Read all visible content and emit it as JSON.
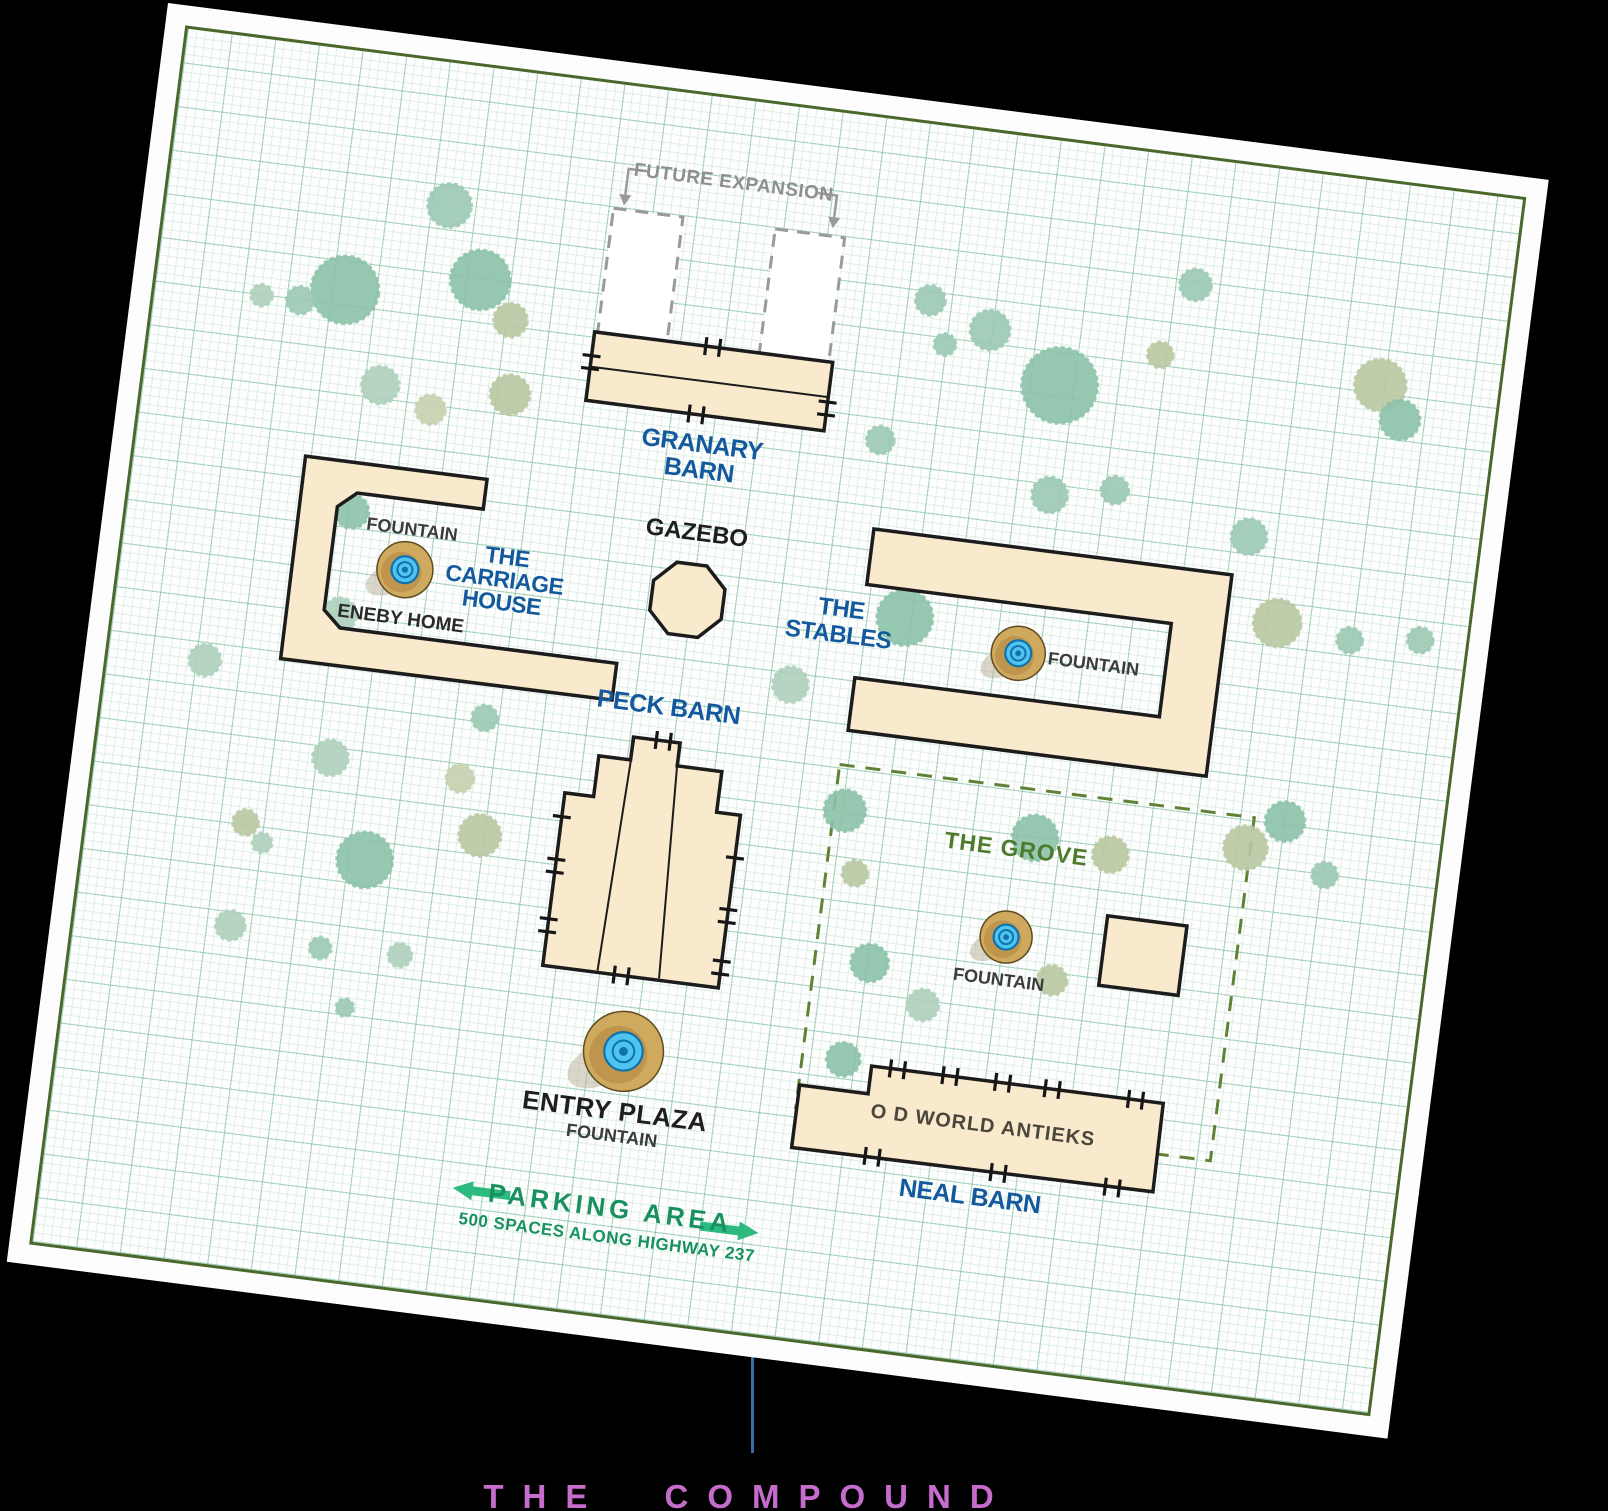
{
  "title": "THE COMPOUND",
  "map": {
    "future_expansion": {
      "label": "FUTURE EXPANSION"
    },
    "granary_barn": {
      "label_line1": "GRANARY",
      "label_line2": "BARN"
    },
    "gazebo": {
      "label": "GAZEBO"
    },
    "carriage_house": {
      "label_line1": "THE",
      "label_line2": "CARRIAGE",
      "label_line3": "HOUSE",
      "fountain_label": "FOUNTAIN",
      "home_label": "ENEBY HOME"
    },
    "stables": {
      "label_line1": "THE",
      "label_line2": "STABLES",
      "fountain_label": "FOUNTAIN"
    },
    "peck_barn": {
      "label": "PECK BARN"
    },
    "grove": {
      "label": "THE GROVE",
      "fountain_label": "FOUNTAIN"
    },
    "entry_plaza": {
      "label_line1": "ENTRY PLAZA",
      "label_line2": "FOUNTAIN"
    },
    "parking": {
      "label": "PARKING AREA",
      "sublabel": "500 SPACES ALONG HIGHWAY 237"
    },
    "neal_barn": {
      "building_text": "O D WORLD ANTIEKS",
      "label": "NEAL BARN"
    }
  },
  "colors": {
    "background": "#000000",
    "paper": "#fcfdfc",
    "border_green": "#4a682c",
    "grid_green": "#bfddd0",
    "building_fill": "#f9e9cd",
    "building_stroke": "#1c1c1c",
    "label_blue": "#14599d",
    "label_green": "#4d7a2b",
    "parking_green": "#18915f",
    "arrow_green": "#2cba7e",
    "title_magenta": "#c56ccd",
    "pointer_blue": "#3a6da7",
    "fountain_tan": "#cfa95d",
    "fountain_blue": "#4fc4f1",
    "fountain_blue_dark": "#0f72ad",
    "tree_palette": [
      "#9bc9b3",
      "#8cc2a9",
      "#aecfbb",
      "#b9c8a2",
      "#c7cfae"
    ]
  },
  "trees": [
    [
      305,
      165,
      22,
      0
    ],
    [
      212,
      262,
      34,
      1
    ],
    [
      169,
      278,
      14,
      0
    ],
    [
      130,
      278,
      11,
      2
    ],
    [
      345,
      235,
      30,
      1
    ],
    [
      380,
      271,
      17,
      3
    ],
    [
      259,
      352,
      19,
      2
    ],
    [
      312,
      370,
      15,
      4
    ],
    [
      389,
      345,
      20,
      3
    ],
    [
      794,
      198,
      15,
      0
    ],
    [
      814,
      240,
      11,
      0
    ],
    [
      857,
      220,
      20,
      0
    ],
    [
      933,
      266,
      38,
      1
    ],
    [
      1029,
      223,
      13,
      3
    ],
    [
      1055,
      149,
      16,
      0
    ],
    [
      1251,
      225,
      26,
      3
    ],
    [
      1275,
      257,
      20,
      1
    ],
    [
      762,
      343,
      14,
      0
    ],
    [
      937,
      376,
      18,
      0
    ],
    [
      1001,
      363,
      14,
      0
    ],
    [
      1140,
      392,
      18,
      0
    ],
    [
      1179,
      474,
      24,
      3
    ],
    [
      1253,
      482,
      13,
      0
    ],
    [
      1323,
      473,
      13,
      0
    ],
    [
      809,
      516,
      28,
      1
    ],
    [
      704,
      597,
      18,
      2
    ],
    [
      120,
      647,
      16,
      2
    ],
    [
      405,
      669,
      13,
      0
    ],
    [
      257,
      728,
      18,
      2
    ],
    [
      388,
      732,
      14,
      4
    ],
    [
      181,
      803,
      13,
      3
    ],
    [
      200,
      821,
      10,
      2
    ],
    [
      304,
      825,
      28,
      1
    ],
    [
      415,
      786,
      21,
      3
    ],
    [
      179,
      907,
      15,
      2
    ],
    [
      271,
      918,
      11,
      0
    ],
    [
      351,
      915,
      12,
      2
    ],
    [
      303,
      974,
      9,
      0
    ],
    [
      247,
      481,
      17,
      1
    ],
    [
      248,
      585,
      17,
      2
    ],
    [
      774,
      715,
      21,
      1
    ],
    [
      792,
      776,
      13,
      3
    ],
    [
      966,
      718,
      23,
      1
    ],
    [
      1043,
      725,
      18,
      3
    ],
    [
      1176,
      701,
      22,
      3
    ],
    [
      1212,
      670,
      20,
      1
    ],
    [
      1258,
      718,
      13,
      0
    ],
    [
      818,
      863,
      19,
      1
    ],
    [
      1001,
      857,
      15,
      3
    ],
    [
      804,
      962,
      17,
      1
    ],
    [
      876,
      898,
      16,
      2
    ]
  ],
  "fountains": [
    {
      "x": 307,
      "y": 532,
      "r": 28
    },
    {
      "x": 926,
      "y": 537,
      "r": 27
    },
    {
      "x": 950,
      "y": 820,
      "r": 26
    },
    {
      "x": 585,
      "y": 982,
      "r": 40
    }
  ]
}
